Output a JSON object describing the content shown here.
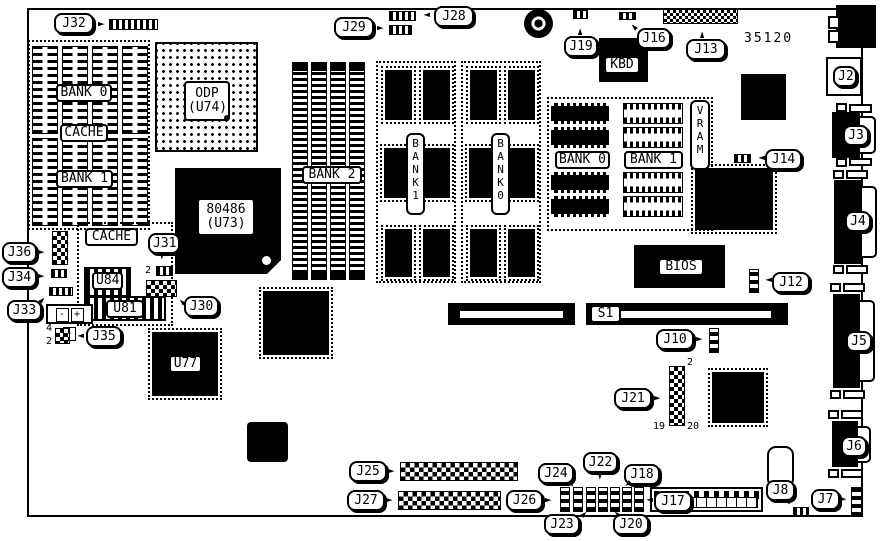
{
  "board_number": "35120",
  "callouts": {
    "j2": "J2",
    "j3": "J3",
    "j4": "J4",
    "j5": "J5",
    "j6": "J6",
    "j7": "J7",
    "j8": "J8",
    "j10": "J10",
    "j12": "J12",
    "j13": "J13",
    "j14": "J14",
    "j16": "J16",
    "j17": "J17",
    "j18": "J18",
    "j19": "J19",
    "j20": "J20",
    "j21": "J21",
    "j22": "J22",
    "j23": "J23",
    "j24": "J24",
    "j25": "J25",
    "j26": "J26",
    "j27": "J27",
    "j28": "J28",
    "j29": "J29",
    "j30": "J30",
    "j31": "J31",
    "j32": "J32",
    "j33": "J33",
    "j34": "J34",
    "j35": "J35",
    "j36": "J36"
  },
  "chips": {
    "odp": "ODP\n(U74)",
    "cpu": "80486\n(U73)",
    "kbd": "KBD",
    "bios": "BIOS",
    "u84": "U84",
    "u81": "U81",
    "u77": "U77"
  },
  "slots": {
    "s1": "S1"
  },
  "memory": {
    "cache_bank0": "BANK 0",
    "cache_mid": "CACHE",
    "cache_bank1": "BANK 1",
    "cache_low": "CACHE",
    "bank2": "BANK 2",
    "bank1_vert": "B\nA\nN\nK\n1",
    "bank0_vert": "B\nA\nN\nK\n0",
    "vram": "V\nR\nA\nM",
    "vram_bank0": "BANK 0",
    "vram_bank1": "BANK 1"
  },
  "pins": {
    "j21_pin2": "2",
    "j21_pin19": "19",
    "j21_pin20": "20",
    "j31_pin2": "2",
    "j35_pin4": "4",
    "j35_pin2": "2"
  },
  "battery": {
    "minus_left": "-",
    "plus": "+",
    "minus_right": "-"
  }
}
